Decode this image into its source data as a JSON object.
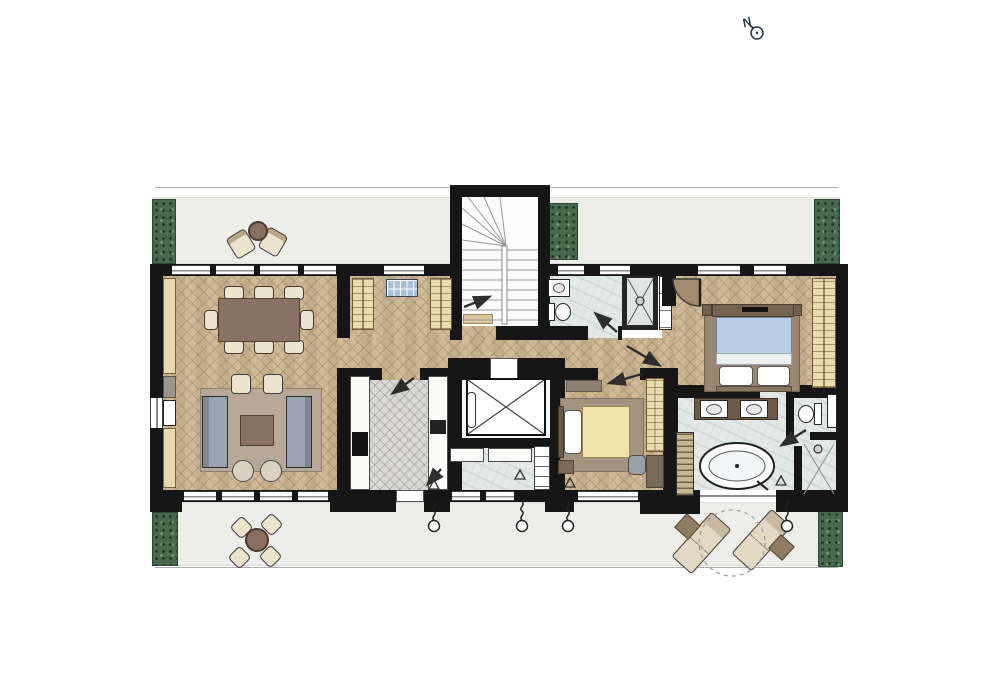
{
  "compass": {
    "label": "N"
  },
  "plan": {
    "type": "apartment floor plan, top-down architectural drawing",
    "rooms": [
      "terrace-north",
      "terrace-south",
      "living-dining-room",
      "entry-foyer",
      "staircase",
      "guest-bathroom",
      "guest-shower",
      "corridor",
      "kitchen",
      "elevator",
      "utility-room",
      "bedroom-2",
      "master-bedroom",
      "master-bathroom",
      "toilet-compartment",
      "master-shower",
      "built-in-wardrobes"
    ],
    "furniture": {
      "living_dining": [
        "dining-table-with-8-chairs",
        "area-rug",
        "two-facing-sofas",
        "coffee-table",
        "two-armchairs",
        "two-round-poufs",
        "wall-built-ins"
      ],
      "entry_foyer": [
        "two-wardrobe-cabinets",
        "glazed-panel"
      ],
      "kitchen": [
        "counter-with-cooktop",
        "counter-with-sink"
      ],
      "guest_bathroom": [
        "washbasin",
        "toilet",
        "shower-with-head"
      ],
      "bedroom_2": [
        "single-bed-yellow",
        "dresser",
        "rug",
        "desk",
        "desk-chair",
        "wardrobe"
      ],
      "master_bedroom": [
        "double-bed-blue",
        "tv-console",
        "nightstands",
        "rug",
        "wardrobe-wall"
      ],
      "master_bathroom": [
        "double-vanity",
        "freestanding-oval-bathtub",
        "toilet",
        "walk-in-shower",
        "towel-radiator"
      ],
      "terrace_north": [
        "two-lounge-chairs",
        "round-coffee-table",
        "planters"
      ],
      "terrace_south": [
        "round-dining-table-4-chairs",
        "two-sun-loungers",
        "two-side-tables",
        "dashed-tree-canopy",
        "planters"
      ]
    },
    "symbols": [
      "north-arrow",
      "door-swing-arrows",
      "door-swing-arc",
      "rain-drain-chains",
      "threshold-triangles",
      "stair-treads",
      "elevator-cross",
      "shower-cross"
    ]
  },
  "colors": {
    "wall": "#161616",
    "wood_floor": "#ccb591",
    "kitchen_floor": "#d9d8d4",
    "marble_floor": "#e4e9e8",
    "terrace": "#edeeea",
    "planter_green": "#47694d",
    "sofa_blue_gray": "#9aa4b1",
    "bed_blue": "#b9cfe6",
    "bed_yellow": "#efe2ab",
    "furniture_brown": "#8a7262",
    "cream_cabinet": "#eadcb0",
    "line_accent": "#2e2e2e"
  }
}
